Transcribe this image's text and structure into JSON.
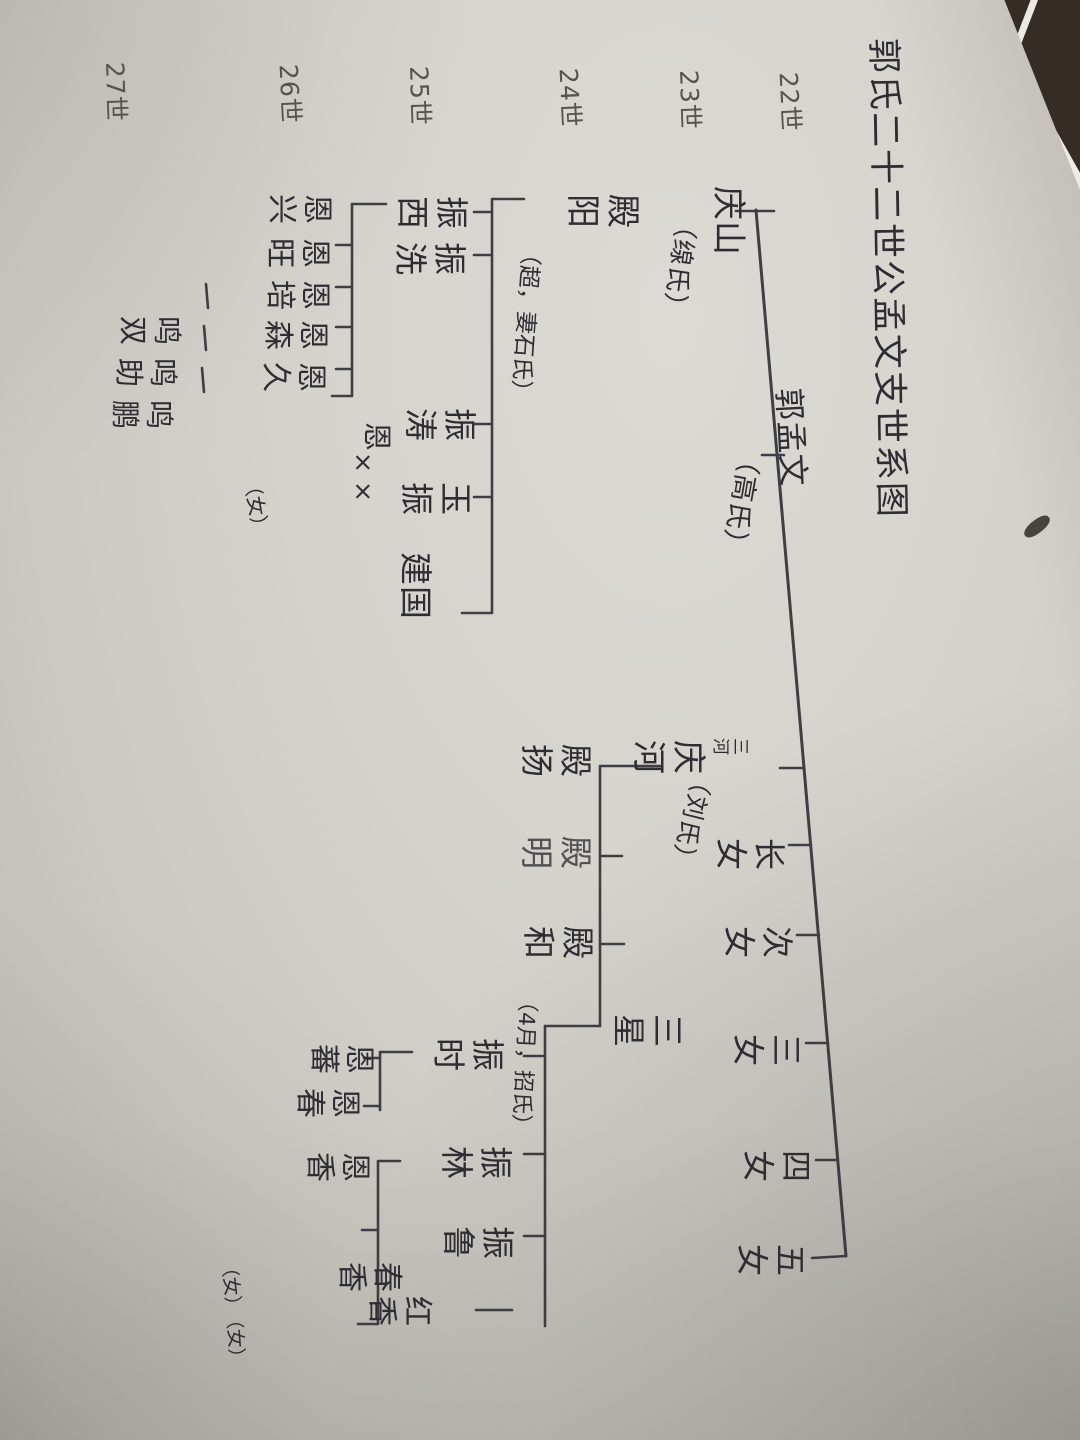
{
  "labels": {
    "title": "郭氏二十二世公孟文支世系图",
    "gen22": "22世",
    "gen23": "23世",
    "gen24": "24世",
    "gen25": "25世",
    "gen26": "26世",
    "gen27": "27世",
    "mengwen": "郭孟文",
    "mengwen_spouse": "（高氏）",
    "qingshan": "庆山",
    "qingshan_spouse": "（缐氏）",
    "sanhe": "三河",
    "qinghe": "庆河",
    "qinghe_spouse": "（刘氏）",
    "zhangnv": "长女",
    "cinv": "次女",
    "sannv": "三女",
    "sinv": "四女",
    "wunv": "五女",
    "dianyang": "殿阳",
    "dianyang_note": "（超，妻石氏）",
    "zhenxi": "振西",
    "zhenxian": "振洗",
    "zhentao": "振涛",
    "yuzhen": "玉振",
    "jianguo": "建国",
    "enxing": "恩兴",
    "enwang": "恩旺",
    "enpei": "恩培",
    "ensen": "恩森",
    "enjiu": "恩久",
    "en_single": "恩",
    "xx": "××",
    "nv": "（女）",
    "mingshuang": "鸣双",
    "mingzhu": "鸣助",
    "mingpeng": "鸣鹏",
    "dianyang2": "殿扬",
    "dianming": "殿明",
    "dianhe": "殿和",
    "sanxing": "三星",
    "sanxing_note": "（4月，招氏）",
    "zhenshi": "振时",
    "zhenlin": "振林",
    "zhenlu": "振鲁",
    "enfan": "恩蕃",
    "enchun": "恩春",
    "enxiang": "恩香",
    "chunxiang": "春香",
    "hongxiang": "红香"
  },
  "tree": {
    "root": {
      "generation": "22世",
      "name": "郭孟文",
      "spouse": "（高氏）",
      "children": [
        {
          "generation": "23世",
          "name": "庆山",
          "spouse": "（缐氏）",
          "children": [
            {
              "generation": "24世",
              "name": "殿阳",
              "note": "（超，妻石氏）",
              "children": [
                {
                  "generation": "25世",
                  "name": "振西",
                  "children": [
                    {
                      "generation": "26世",
                      "name": "恩兴"
                    },
                    {
                      "generation": "26世",
                      "name": "恩旺"
                    },
                    {
                      "generation": "26世",
                      "name": "恩培",
                      "children": [
                        {
                          "generation": "27世",
                          "name": "鸣双"
                        }
                      ]
                    },
                    {
                      "generation": "26世",
                      "name": "恩森",
                      "children": [
                        {
                          "generation": "27世",
                          "name": "鸣助"
                        }
                      ]
                    },
                    {
                      "generation": "26世",
                      "name": "恩久",
                      "children": [
                        {
                          "generation": "27世",
                          "name": "鸣鹏"
                        }
                      ]
                    }
                  ]
                },
                {
                  "generation": "25世",
                  "name": "振洗"
                },
                {
                  "generation": "25世",
                  "name": "振涛",
                  "children": [
                    {
                      "generation": "26世",
                      "name": "恩××",
                      "note": "（女）"
                    }
                  ]
                },
                {
                  "generation": "25世",
                  "name": "玉振"
                },
                {
                  "generation": "25世",
                  "name": "建国"
                }
              ]
            }
          ]
        },
        {
          "generation": "23世",
          "name": "庆河",
          "alias": "三河",
          "spouse": "（刘氏）",
          "children": [
            {
              "generation": "24世",
              "name": "殿扬"
            },
            {
              "generation": "24世",
              "name": "殿明"
            },
            {
              "generation": "24世",
              "name": "殿和"
            },
            {
              "generation": "24世",
              "name": "三星",
              "note": "（4月，招氏）",
              "children": [
                {
                  "generation": "25世",
                  "name": "振时",
                  "children": [
                    {
                      "generation": "26世",
                      "name": "恩蕃"
                    },
                    {
                      "generation": "26世",
                      "name": "恩春"
                    }
                  ]
                },
                {
                  "generation": "25世",
                  "name": "振林",
                  "children": [
                    {
                      "generation": "26世",
                      "name": "恩香"
                    },
                    {
                      "generation": "26世",
                      "name": "春香",
                      "note": "（女）"
                    },
                    {
                      "generation": "26世",
                      "name": "红香",
                      "note": "（女）"
                    }
                  ]
                },
                {
                  "generation": "25世",
                  "name": "振鲁"
                }
              ]
            }
          ]
        },
        {
          "generation": "23世",
          "name": "长女"
        },
        {
          "generation": "23世",
          "name": "次女"
        },
        {
          "generation": "23世",
          "name": "三女"
        },
        {
          "generation": "23世",
          "name": "四女"
        },
        {
          "generation": "23世",
          "name": "五女"
        }
      ]
    }
  }
}
